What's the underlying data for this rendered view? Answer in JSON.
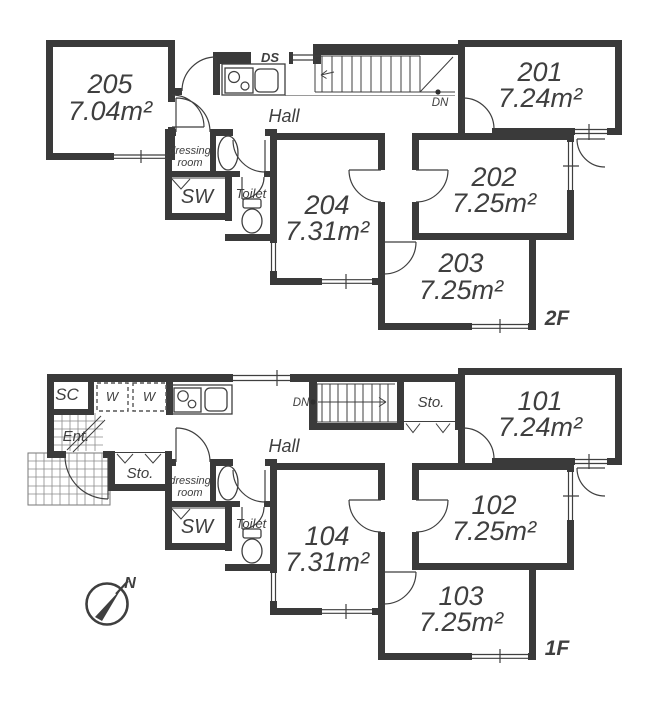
{
  "colors": {
    "wall": "#3a3a3a",
    "line": "#3f3f3f",
    "text": "#3f3f3f"
  },
  "floor2": {
    "floor_label": "2F",
    "hall_label": "Hall",
    "ds_label": "DS",
    "dn_label": "DN",
    "sw_label": "SW",
    "toilet_label": "Toilet",
    "dressing_label_line1": "dressing",
    "dressing_label_line2": "room",
    "rooms": {
      "r201": {
        "number": "201",
        "area": "7.24m²"
      },
      "r202": {
        "number": "202",
        "area": "7.25m²"
      },
      "r203": {
        "number": "203",
        "area": "7.25m²"
      },
      "r204": {
        "number": "204",
        "area": "7.31m²"
      },
      "r205": {
        "number": "205",
        "area": "7.04m²"
      }
    }
  },
  "floor1": {
    "floor_label": "1F",
    "hall_label": "Hall",
    "dn_label": "DN",
    "sw_label": "SW",
    "toilet_label": "Toilet",
    "sc_label": "SC",
    "ent_label": "Ent.",
    "sto_entry_label": "Sto.",
    "sto_stairs_label": "Sto.",
    "w_left_label": "W",
    "w_right_label": "W",
    "dressing_label_line1": "dressing",
    "dressing_label_line2": "room",
    "rooms": {
      "r101": {
        "number": "101",
        "area": "7.24m²"
      },
      "r102": {
        "number": "102",
        "area": "7.25m²"
      },
      "r103": {
        "number": "103",
        "area": "7.25m²"
      },
      "r104": {
        "number": "104",
        "area": "7.31m²"
      }
    }
  },
  "compass": {
    "north_label": "N"
  }
}
